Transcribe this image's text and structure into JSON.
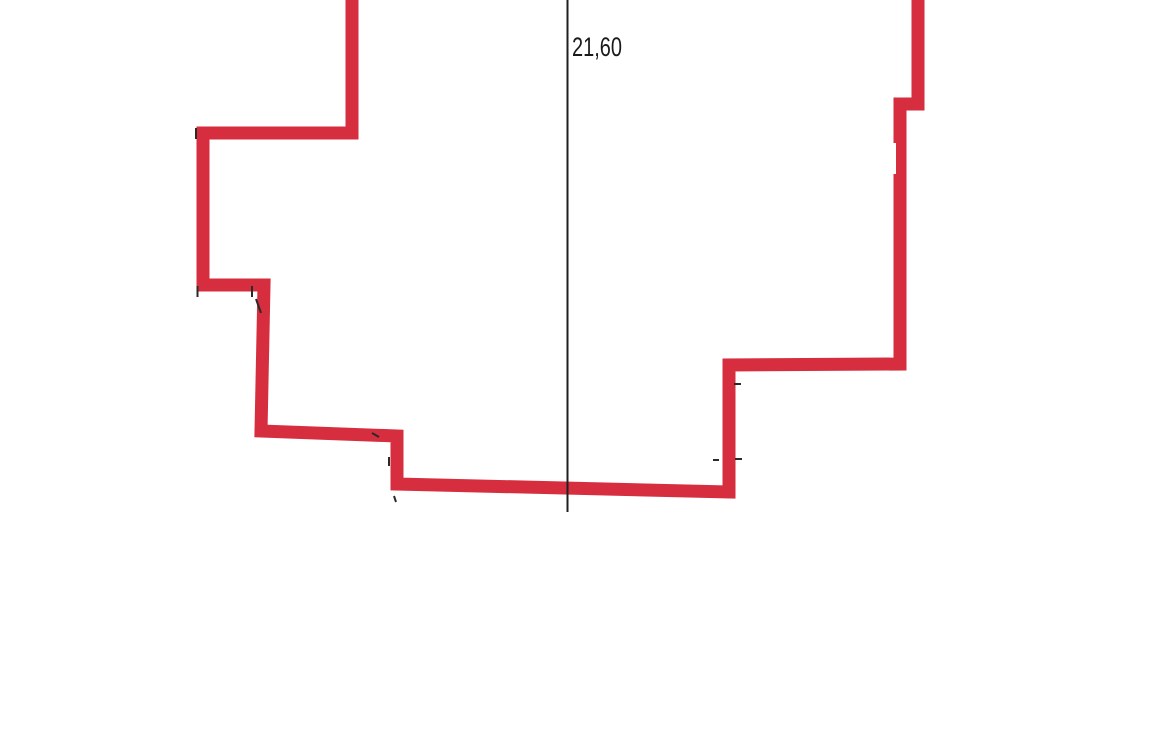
{
  "page": {
    "width": 1170,
    "height": 738,
    "background": "#ffffff"
  },
  "drawing": {
    "kind": "plot-outline-with-dimension",
    "dimension_label": "21,60",
    "colors": {
      "outline": "#d62e3e",
      "dimension_line": "#1f1f1f",
      "label": "#1a1a1a",
      "tick": "#2a2a2a",
      "paper": "#ffffff"
    },
    "outline_stroke_width": 13,
    "outline_points": [
      [
        352,
        -8
      ],
      [
        352,
        133
      ],
      [
        203,
        133
      ],
      [
        203,
        285
      ],
      [
        264,
        285
      ],
      [
        261,
        431
      ],
      [
        397,
        436
      ],
      [
        397,
        484
      ],
      [
        729,
        492
      ],
      [
        729,
        365
      ],
      [
        900,
        364
      ],
      [
        900,
        104
      ],
      [
        918,
        104
      ],
      [
        918,
        -8
      ]
    ],
    "dimension_line": {
      "x": 567.5,
      "y1": 0,
      "y2": 512,
      "stroke_width": 2
    },
    "label": {
      "x": 572,
      "y": 56,
      "font_size": 27,
      "text_length": 50
    },
    "tick_marks": [
      {
        "x1": 196,
        "y1": 128,
        "x2": 196,
        "y2": 139
      },
      {
        "x1": 197.5,
        "y1": 286,
        "x2": 197.5,
        "y2": 297
      },
      {
        "x1": 252,
        "y1": 286,
        "x2": 252,
        "y2": 297
      },
      {
        "x1": 256,
        "y1": 299,
        "x2": 261,
        "y2": 313
      },
      {
        "x1": 372,
        "y1": 433,
        "x2": 379,
        "y2": 437
      },
      {
        "x1": 389,
        "y1": 457,
        "x2": 389,
        "y2": 466
      },
      {
        "x1": 394,
        "y1": 496,
        "x2": 396,
        "y2": 502
      },
      {
        "x1": 734,
        "y1": 384,
        "x2": 741,
        "y2": 384
      },
      {
        "x1": 713,
        "y1": 460,
        "x2": 719,
        "y2": 460
      },
      {
        "x1": 735,
        "y1": 459,
        "x2": 742,
        "y2": 459
      }
    ],
    "white_patch": {
      "x": 889,
      "y": 143,
      "width": 7,
      "height": 31
    }
  }
}
